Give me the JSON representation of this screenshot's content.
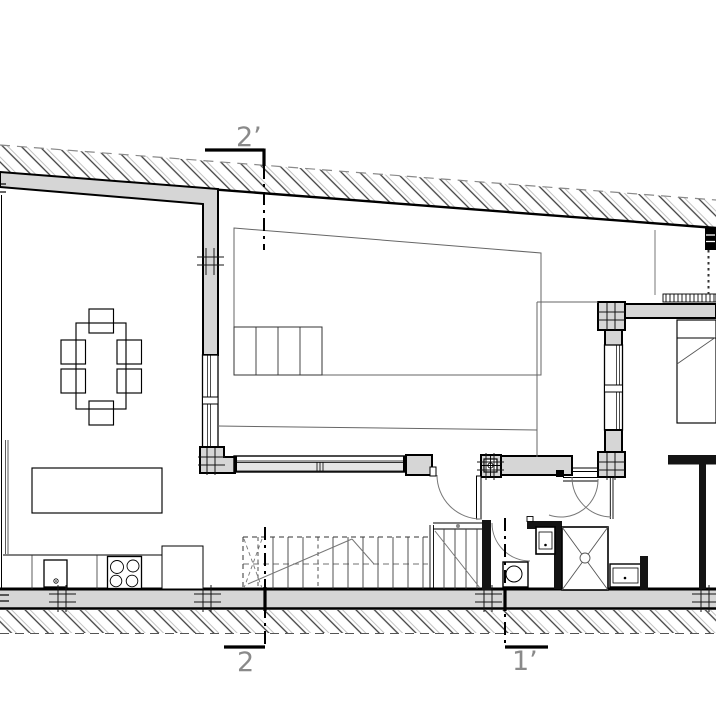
{
  "drawing": {
    "section_markers": {
      "top": {
        "label": "2’"
      },
      "bottom_left": {
        "label": "2"
      },
      "bottom_right": {
        "label": "1’"
      }
    },
    "colors": {
      "wall_fill": "#d6d6d6",
      "line": "#000000",
      "hatch": "#555555",
      "label": "#8a8a8a",
      "background": "#ffffff"
    }
  }
}
